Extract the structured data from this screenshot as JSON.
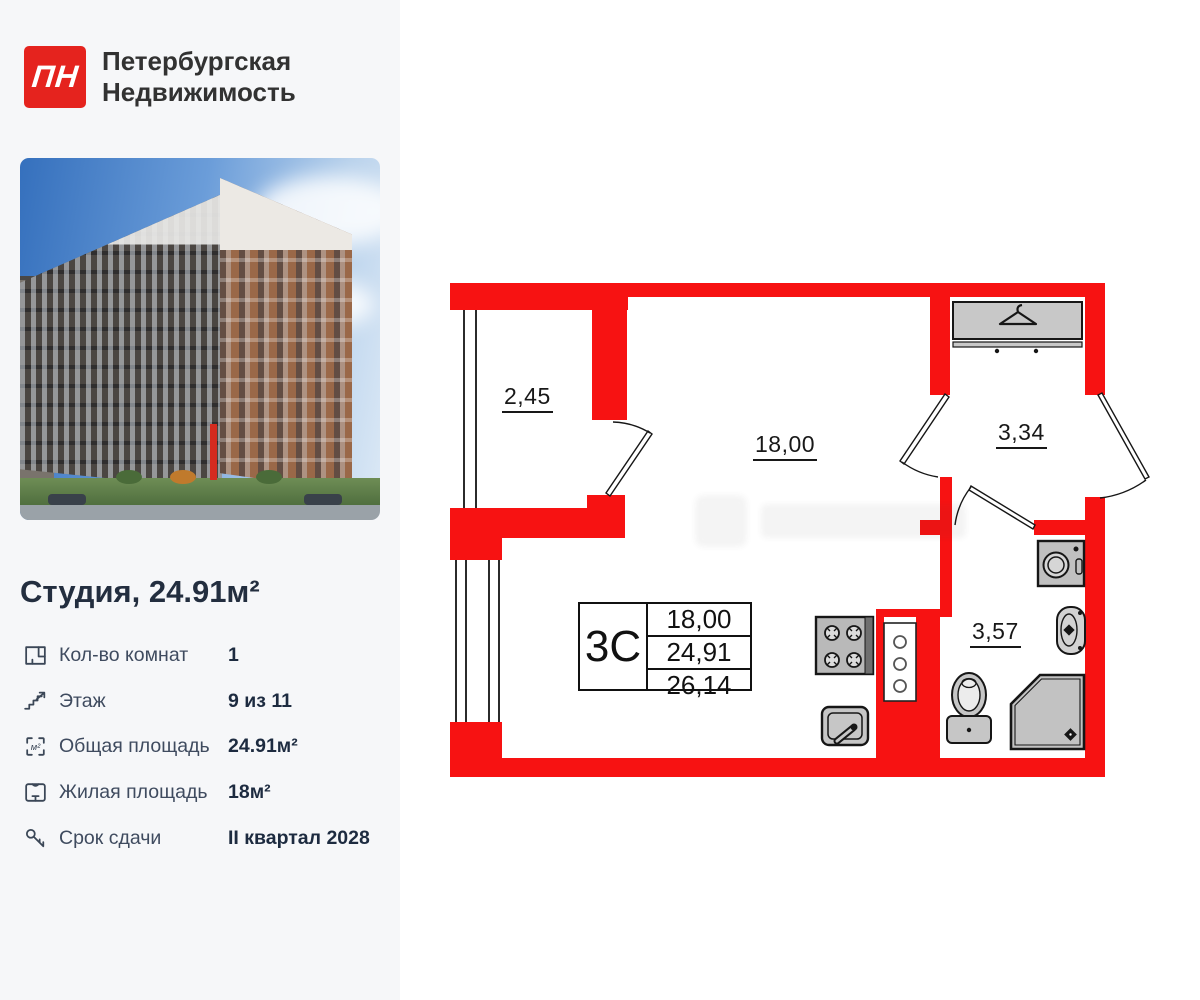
{
  "header": {
    "logo": "ПН",
    "company_line1": "Петербургская",
    "company_line2": "Недвижимость"
  },
  "listing": {
    "title": "Студия, 24.91м²",
    "details": [
      {
        "icon": "rooms-plan-icon",
        "label": "Кол-во комнат",
        "value": "1"
      },
      {
        "icon": "stairs-icon",
        "label": "Этаж",
        "value": "9 из 11"
      },
      {
        "icon": "total-area-icon",
        "label": "Общая площадь",
        "value": "24.91м²"
      },
      {
        "icon": "living-area-icon",
        "label": "Жилая площадь",
        "value": "18м²"
      },
      {
        "icon": "key-icon",
        "label": "Срок сдачи",
        "value": "II квартал 2028"
      }
    ]
  },
  "plan": {
    "rooms": {
      "balcony": "2,45",
      "living": "18,00",
      "hall": "3,34",
      "bath": "3,57"
    },
    "table": {
      "type": "3С",
      "values": [
        "18,00",
        "24,91",
        "26,14"
      ]
    }
  },
  "colors": {
    "wall": "#f71212",
    "brand": "#e5231e",
    "panel_bg": "#f6f7f9",
    "fixture_gray": "#c4c4c4"
  }
}
